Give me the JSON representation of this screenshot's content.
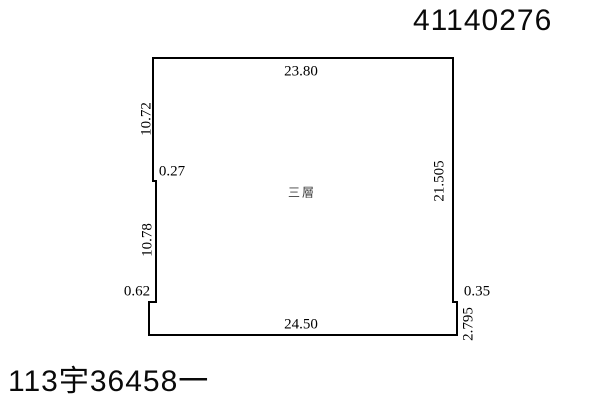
{
  "sheet": {
    "sheet_number": "41140276",
    "case_number": "113宇36458一"
  },
  "plan": {
    "floor_label": "三層",
    "outline_color": "#000000",
    "background_color": "#ffffff",
    "dimensions": {
      "top": "23.80",
      "left_upper": "10.72",
      "left_jog": "0.27",
      "left_lower": "10.78",
      "bottom_left_jog": "0.62",
      "right": "21.505",
      "right_jog": "0.35",
      "right_stub": "2.795",
      "bottom": "24.50"
    }
  }
}
